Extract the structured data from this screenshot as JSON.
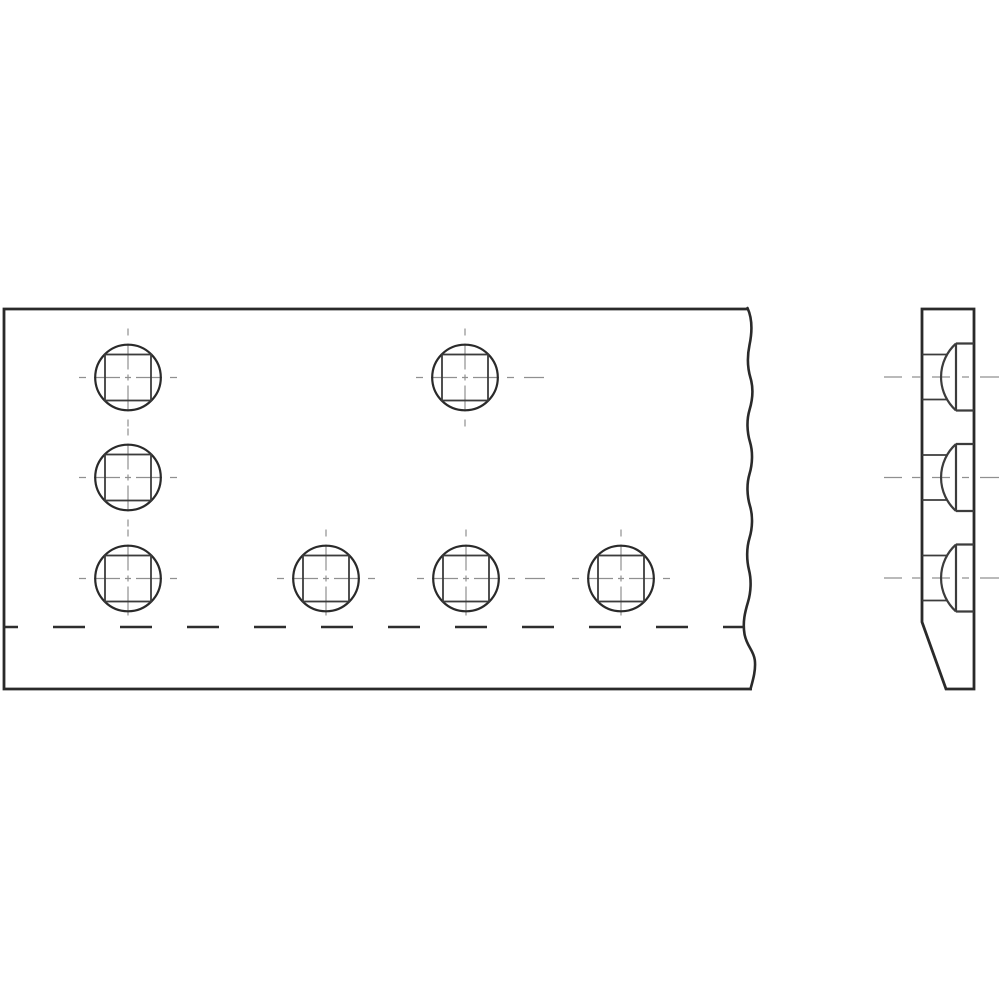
{
  "drawing": {
    "description": "orthographic-projection-plate-with-carriage-bolts",
    "colors": {
      "background": "#ffffff",
      "outline": "#2a2a2a",
      "detail": "#3c3c3c",
      "centerline": "#909090",
      "hidden_dash": "#2e2e2e"
    },
    "front_view": {
      "plate": {
        "left": 4,
        "top": 309,
        "bottom": 689,
        "break_top_x": 747.5,
        "break_bottom_x": 750.5
      },
      "hole_radius": 32.8,
      "square_side": 46,
      "centerline_half_extent": 49,
      "holes": [
        {
          "cx": 128,
          "cy": 377.5,
          "short_bottom": false,
          "extra_right_dash": false
        },
        {
          "cx": 465,
          "cy": 377.5,
          "short_bottom": false,
          "extra_right_dash": true
        },
        {
          "cx": 128,
          "cy": 477.5,
          "short_bottom": false,
          "extra_right_dash": false
        },
        {
          "cx": 128,
          "cy": 578.5,
          "short_bottom": true,
          "extra_right_dash": false
        },
        {
          "cx": 326,
          "cy": 578.5,
          "short_bottom": true,
          "extra_right_dash": false
        },
        {
          "cx": 466,
          "cy": 578.5,
          "short_bottom": true,
          "extra_right_dash": true
        },
        {
          "cx": 621,
          "cy": 578.5,
          "short_bottom": true,
          "extra_right_dash": false
        }
      ],
      "hidden_line": {
        "y": 627,
        "x1": 3,
        "x2": 745
      }
    },
    "side_view": {
      "left": 922,
      "right": 974,
      "top": 309,
      "bottom": 689,
      "chamfer": {
        "start_y": 622,
        "bottom_x": 946
      },
      "head_flat_x": 956,
      "head_half_height": 33.5,
      "shoulder_half_height": 22.5,
      "dome_left_x": 941,
      "shoulder_end_x": 947,
      "dome_radius": 45,
      "heads": [
        {
          "cy": 377
        },
        {
          "cy": 477.5
        },
        {
          "cy": 578
        }
      ],
      "centerline": {
        "x1": 884,
        "x2": 999
      }
    }
  }
}
